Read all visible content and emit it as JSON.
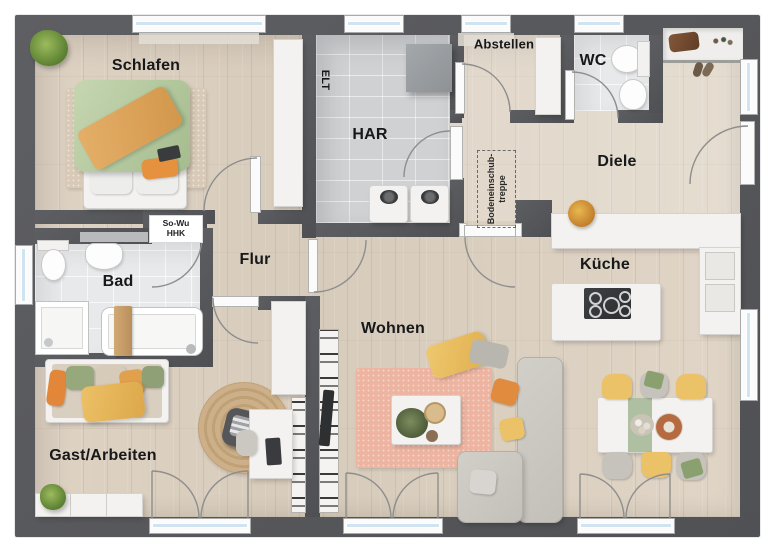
{
  "plan": {
    "title": "Erdgeschoss Grundriss",
    "type": "floor-plan",
    "language": "de",
    "rooms": {
      "schlafen": {
        "label": "Schlafen"
      },
      "har": {
        "label": "HAR"
      },
      "abstellen": {
        "label": "Abstellen"
      },
      "wc": {
        "label": "WC"
      },
      "diele": {
        "label": "Diele"
      },
      "bad": {
        "label": "Bad"
      },
      "flur": {
        "label": "Flur"
      },
      "kueche": {
        "label": "Küche"
      },
      "wohnen": {
        "label": "Wohnen"
      },
      "gast": {
        "label": "Gast/Arbeiten"
      }
    },
    "annotations": {
      "elt": "ELT",
      "heating": {
        "line1": "So-Wu",
        "line2": "HHK"
      },
      "attic_stairs": {
        "line1": "Bodeneinschub-",
        "line2": "treppe"
      }
    },
    "colors": {
      "wall": "#56575b",
      "wood_floor": "#dccfc0",
      "tile_har": "#d0d2d4",
      "tile_bath": "#e7e9ea",
      "accent_orange": "#e5913d",
      "accent_yellow": "#ecc268",
      "accent_green": "#9fb287",
      "rug_pink": "#edb5a1",
      "rug_jute": "#c2a279",
      "sofa_gray": "#c9c6c0",
      "window_glass": "#cfe4f0"
    }
  }
}
